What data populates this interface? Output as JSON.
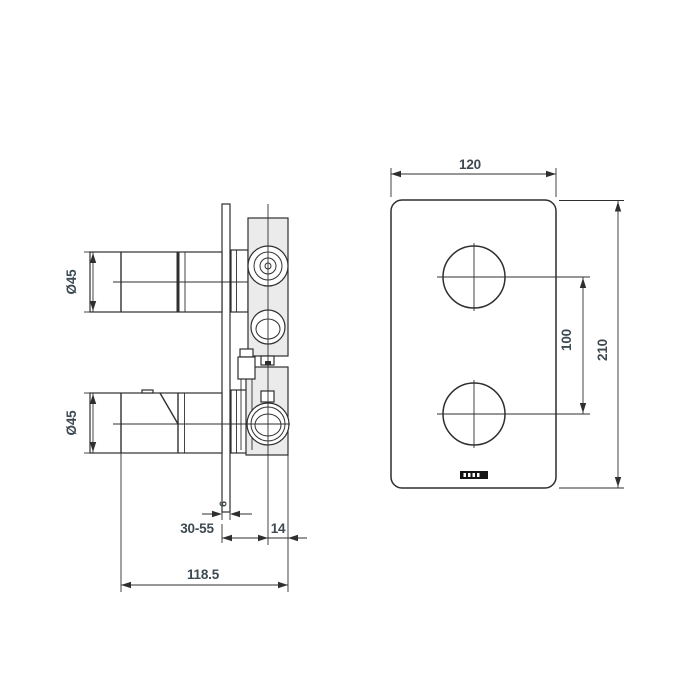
{
  "drawing": {
    "type": "technical-drawing",
    "background": "#ffffff",
    "line_color": "#2f2f2f",
    "text_color": "#3d4a52",
    "body_fill": "#ebebeb",
    "logo_color": "#151515"
  },
  "side_view": {
    "dim_top_handle_diameter": "Ø45",
    "dim_bottom_handle_diameter": "Ø45",
    "dim_plate_thickness": "6",
    "dim_wall_depth_range": "30-55",
    "dim_center_to_back": "14",
    "dim_total_depth": "118.5"
  },
  "front_view": {
    "dim_plate_width": "120",
    "dim_plate_height": "210",
    "dim_handle_spacing": "100"
  }
}
